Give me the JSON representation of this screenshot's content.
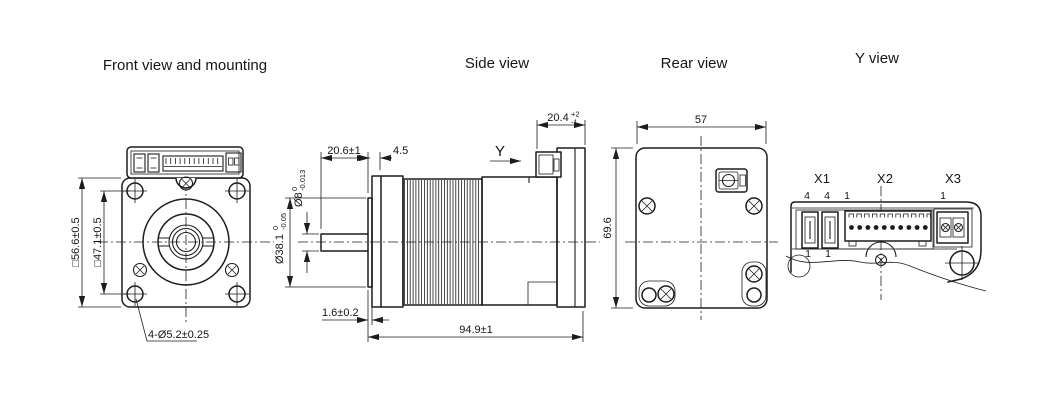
{
  "colors": {
    "line": "#1d1d1d",
    "background": "#ffffff"
  },
  "views": {
    "front": {
      "title": "Front view and mounting",
      "dims": {
        "outer": "□56.6±0.5",
        "bolt": "□47.1±0.5",
        "holes": "4-Ø5.2±0.25"
      }
    },
    "side": {
      "title": "Side view",
      "view_label": "Y",
      "dims": {
        "shaft_len": "20.6±1",
        "flange_thk": "4.5",
        "conn_w": "20.4",
        "conn_w_hi": "+2",
        "conn_w_lo": "-1",
        "shaft_dia": "Ø8",
        "shaft_dia_hi": "0",
        "shaft_dia_lo": "-0.013",
        "pilot_dia": "Ø38.1",
        "pilot_dia_hi": "0",
        "pilot_dia_lo": "-0.05",
        "pilot_len": "1.6±0.2",
        "total_len": "94.9±1"
      }
    },
    "rear": {
      "title": "Rear view",
      "dims": {
        "width": "57",
        "height": "69.6"
      }
    },
    "yview": {
      "title": "Y view",
      "connectors": {
        "x1": "X1",
        "x2": "X2",
        "x3": "X3"
      },
      "pins": {
        "x1a_top": "4",
        "x1b_top": "4",
        "x2_top": "1",
        "x3_top": "1",
        "x1a_bot": "1",
        "x1b_bot": "1"
      }
    }
  }
}
